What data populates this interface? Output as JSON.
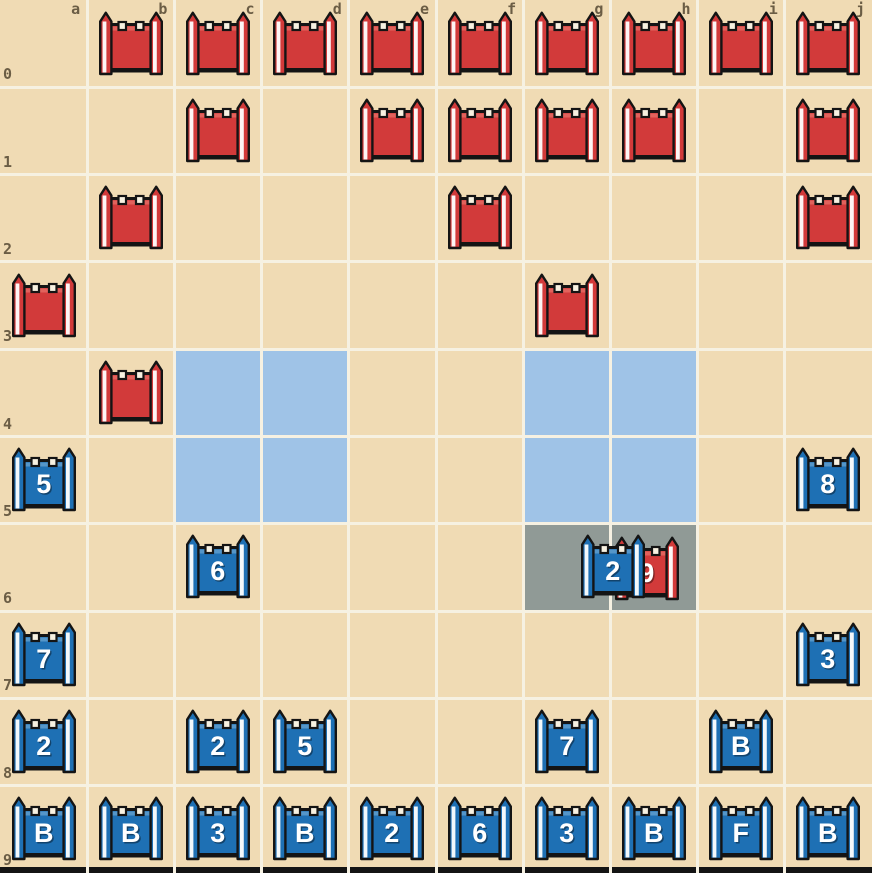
{
  "board": {
    "columns": [
      "a",
      "b",
      "c",
      "d",
      "e",
      "f",
      "g",
      "h",
      "i",
      "j"
    ],
    "rows": [
      "0",
      "1",
      "2",
      "3",
      "4",
      "5",
      "6",
      "7",
      "8",
      "9"
    ],
    "lakes": [
      "c4",
      "d4",
      "c5",
      "d5",
      "g4",
      "h4",
      "g5",
      "h5"
    ],
    "combat_highlight_cells": [
      "g6",
      "h6"
    ],
    "pieces": [
      {
        "square": "b0",
        "side": "red",
        "label": ""
      },
      {
        "square": "c0",
        "side": "red",
        "label": ""
      },
      {
        "square": "d0",
        "side": "red",
        "label": ""
      },
      {
        "square": "e0",
        "side": "red",
        "label": ""
      },
      {
        "square": "f0",
        "side": "red",
        "label": ""
      },
      {
        "square": "g0",
        "side": "red",
        "label": ""
      },
      {
        "square": "h0",
        "side": "red",
        "label": ""
      },
      {
        "square": "i0",
        "side": "red",
        "label": ""
      },
      {
        "square": "j0",
        "side": "red",
        "label": ""
      },
      {
        "square": "c1",
        "side": "red",
        "label": ""
      },
      {
        "square": "e1",
        "side": "red",
        "label": ""
      },
      {
        "square": "f1",
        "side": "red",
        "label": ""
      },
      {
        "square": "g1",
        "side": "red",
        "label": ""
      },
      {
        "square": "h1",
        "side": "red",
        "label": ""
      },
      {
        "square": "j1",
        "side": "red",
        "label": ""
      },
      {
        "square": "b2",
        "side": "red",
        "label": ""
      },
      {
        "square": "f2",
        "side": "red",
        "label": ""
      },
      {
        "square": "j2",
        "side": "red",
        "label": ""
      },
      {
        "square": "a3",
        "side": "red",
        "label": ""
      },
      {
        "square": "g3",
        "side": "red",
        "label": ""
      },
      {
        "square": "b4",
        "side": "red",
        "label": ""
      },
      {
        "square": "a5",
        "side": "blue",
        "label": "5"
      },
      {
        "square": "j5",
        "side": "blue",
        "label": "8"
      },
      {
        "square": "c6",
        "side": "blue",
        "label": "6"
      },
      {
        "square": "h6",
        "side": "red",
        "label": "9",
        "dx": -7,
        "dy": 2,
        "z": 5
      },
      {
        "square": "g6",
        "side": "blue",
        "label": "2",
        "dx": 46,
        "dy": 0,
        "z": 6
      },
      {
        "square": "a7",
        "side": "blue",
        "label": "7"
      },
      {
        "square": "j7",
        "side": "blue",
        "label": "3"
      },
      {
        "square": "a8",
        "side": "blue",
        "label": "2"
      },
      {
        "square": "c8",
        "side": "blue",
        "label": "2"
      },
      {
        "square": "d8",
        "side": "blue",
        "label": "5"
      },
      {
        "square": "g8",
        "side": "blue",
        "label": "7"
      },
      {
        "square": "i8",
        "side": "blue",
        "label": "B"
      },
      {
        "square": "a9",
        "side": "blue",
        "label": "B"
      },
      {
        "square": "b9",
        "side": "blue",
        "label": "B"
      },
      {
        "square": "c9",
        "side": "blue",
        "label": "3"
      },
      {
        "square": "d9",
        "side": "blue",
        "label": "B"
      },
      {
        "square": "e9",
        "side": "blue",
        "label": "2"
      },
      {
        "square": "f9",
        "side": "blue",
        "label": "6"
      },
      {
        "square": "g9",
        "side": "blue",
        "label": "3"
      },
      {
        "square": "h9",
        "side": "blue",
        "label": "B"
      },
      {
        "square": "i9",
        "side": "blue",
        "label": "F"
      },
      {
        "square": "j9",
        "side": "blue",
        "label": "B"
      }
    ]
  },
  "colors": {
    "background_land": "#f0dbb4",
    "grid_line": "#f6f1e2",
    "lake": "#9fc3e7",
    "combat_highlight": "#909a96",
    "red_piece": "#d23a3a",
    "red_piece_light": "#e2625c",
    "blue_piece": "#1e70b4",
    "blue_piece_light": "#5596c9",
    "notch": "#f7f1e1",
    "piece_outline": "#141414",
    "piece_text": "#ffffff",
    "coordinate_text": "#6b5d45",
    "board_edge": "#141414"
  }
}
